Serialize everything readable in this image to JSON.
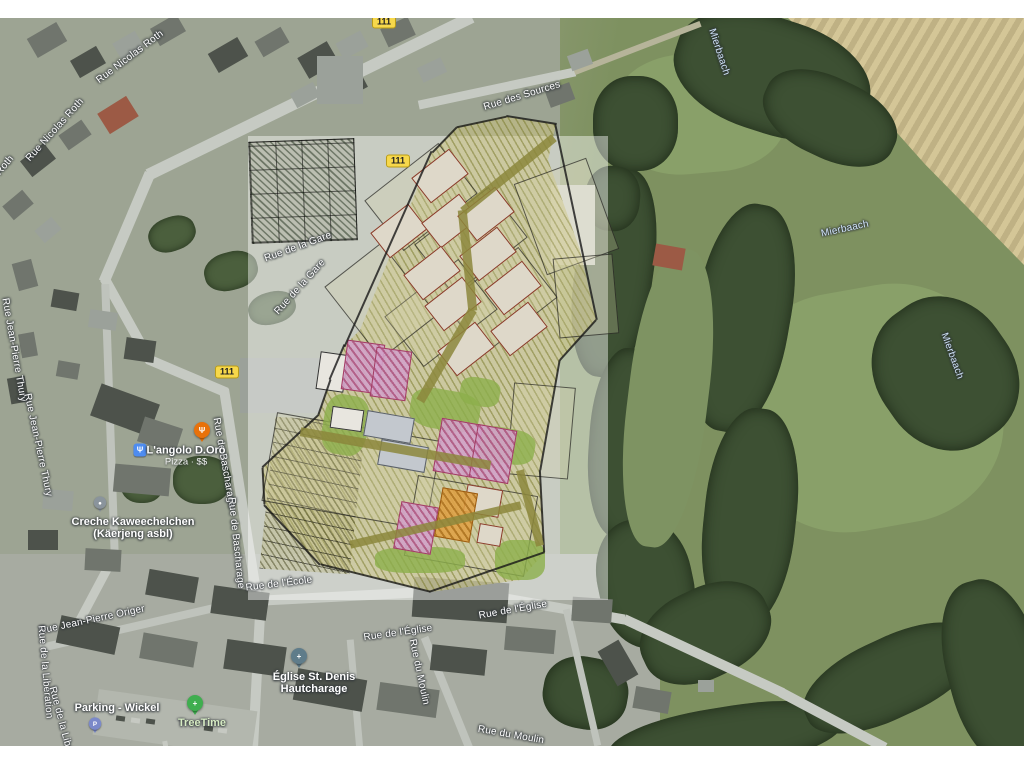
{
  "route_badges": [
    "111",
    "111",
    "111"
  ],
  "street_labels": [
    "Rue Nicolas Roth",
    "Rue Nicolas Roth",
    "Rue Nicolas Roth",
    "Rue des Sources",
    "Rue de la Gare",
    "Rue de la Gare",
    "Rue de Bascharage",
    "Rue de Bascharage",
    "Rue Jean-Pierre Thury",
    "Rue Jean-Pierre Thury",
    "Rue Jean-Pierre Origer",
    "Rue de la Libération",
    "Rue de la Libération",
    "Rue de l'École",
    "Rue de l'Église",
    "Rue de l'Église",
    "Rue du Moulin",
    "Rue du Moulin"
  ],
  "water_labels": [
    "Mierbaach",
    "Mierbaach",
    "Mierbaach"
  ],
  "pois": {
    "restaurant": {
      "name": "L'angolo D.Oro",
      "details": "Pizza · $$"
    },
    "creche": {
      "line1": "Creche Kaweechelchen",
      "line2": "(Käerjeng asbl)"
    },
    "church": {
      "line1": "Église St. Denis",
      "line2": "Hautcharage"
    },
    "parking": {
      "name": "Parking - Wickel"
    },
    "treetime": {
      "name": "TreeTime"
    }
  },
  "icons": {
    "restaurant_pin": "Ψ",
    "restaurant_category": "Ψ",
    "parking_pin": "P",
    "church_pin": "+",
    "treetime_pin": "+",
    "creche_pin": "●"
  },
  "colors": {
    "route_badge": "#f7d84b",
    "water_label": "#cfe2f8",
    "restaurant_pin": "#e8710a",
    "parking_pin": "#7b89c9",
    "treetime_pin": "#3fae4f",
    "church_pin": "#5f7c8a",
    "creche_pin": "#8a949c",
    "plan_pink": "#d2a3c9",
    "plan_orange": "#dfa044",
    "plan_hatch_olive": "#8f8f3f"
  }
}
